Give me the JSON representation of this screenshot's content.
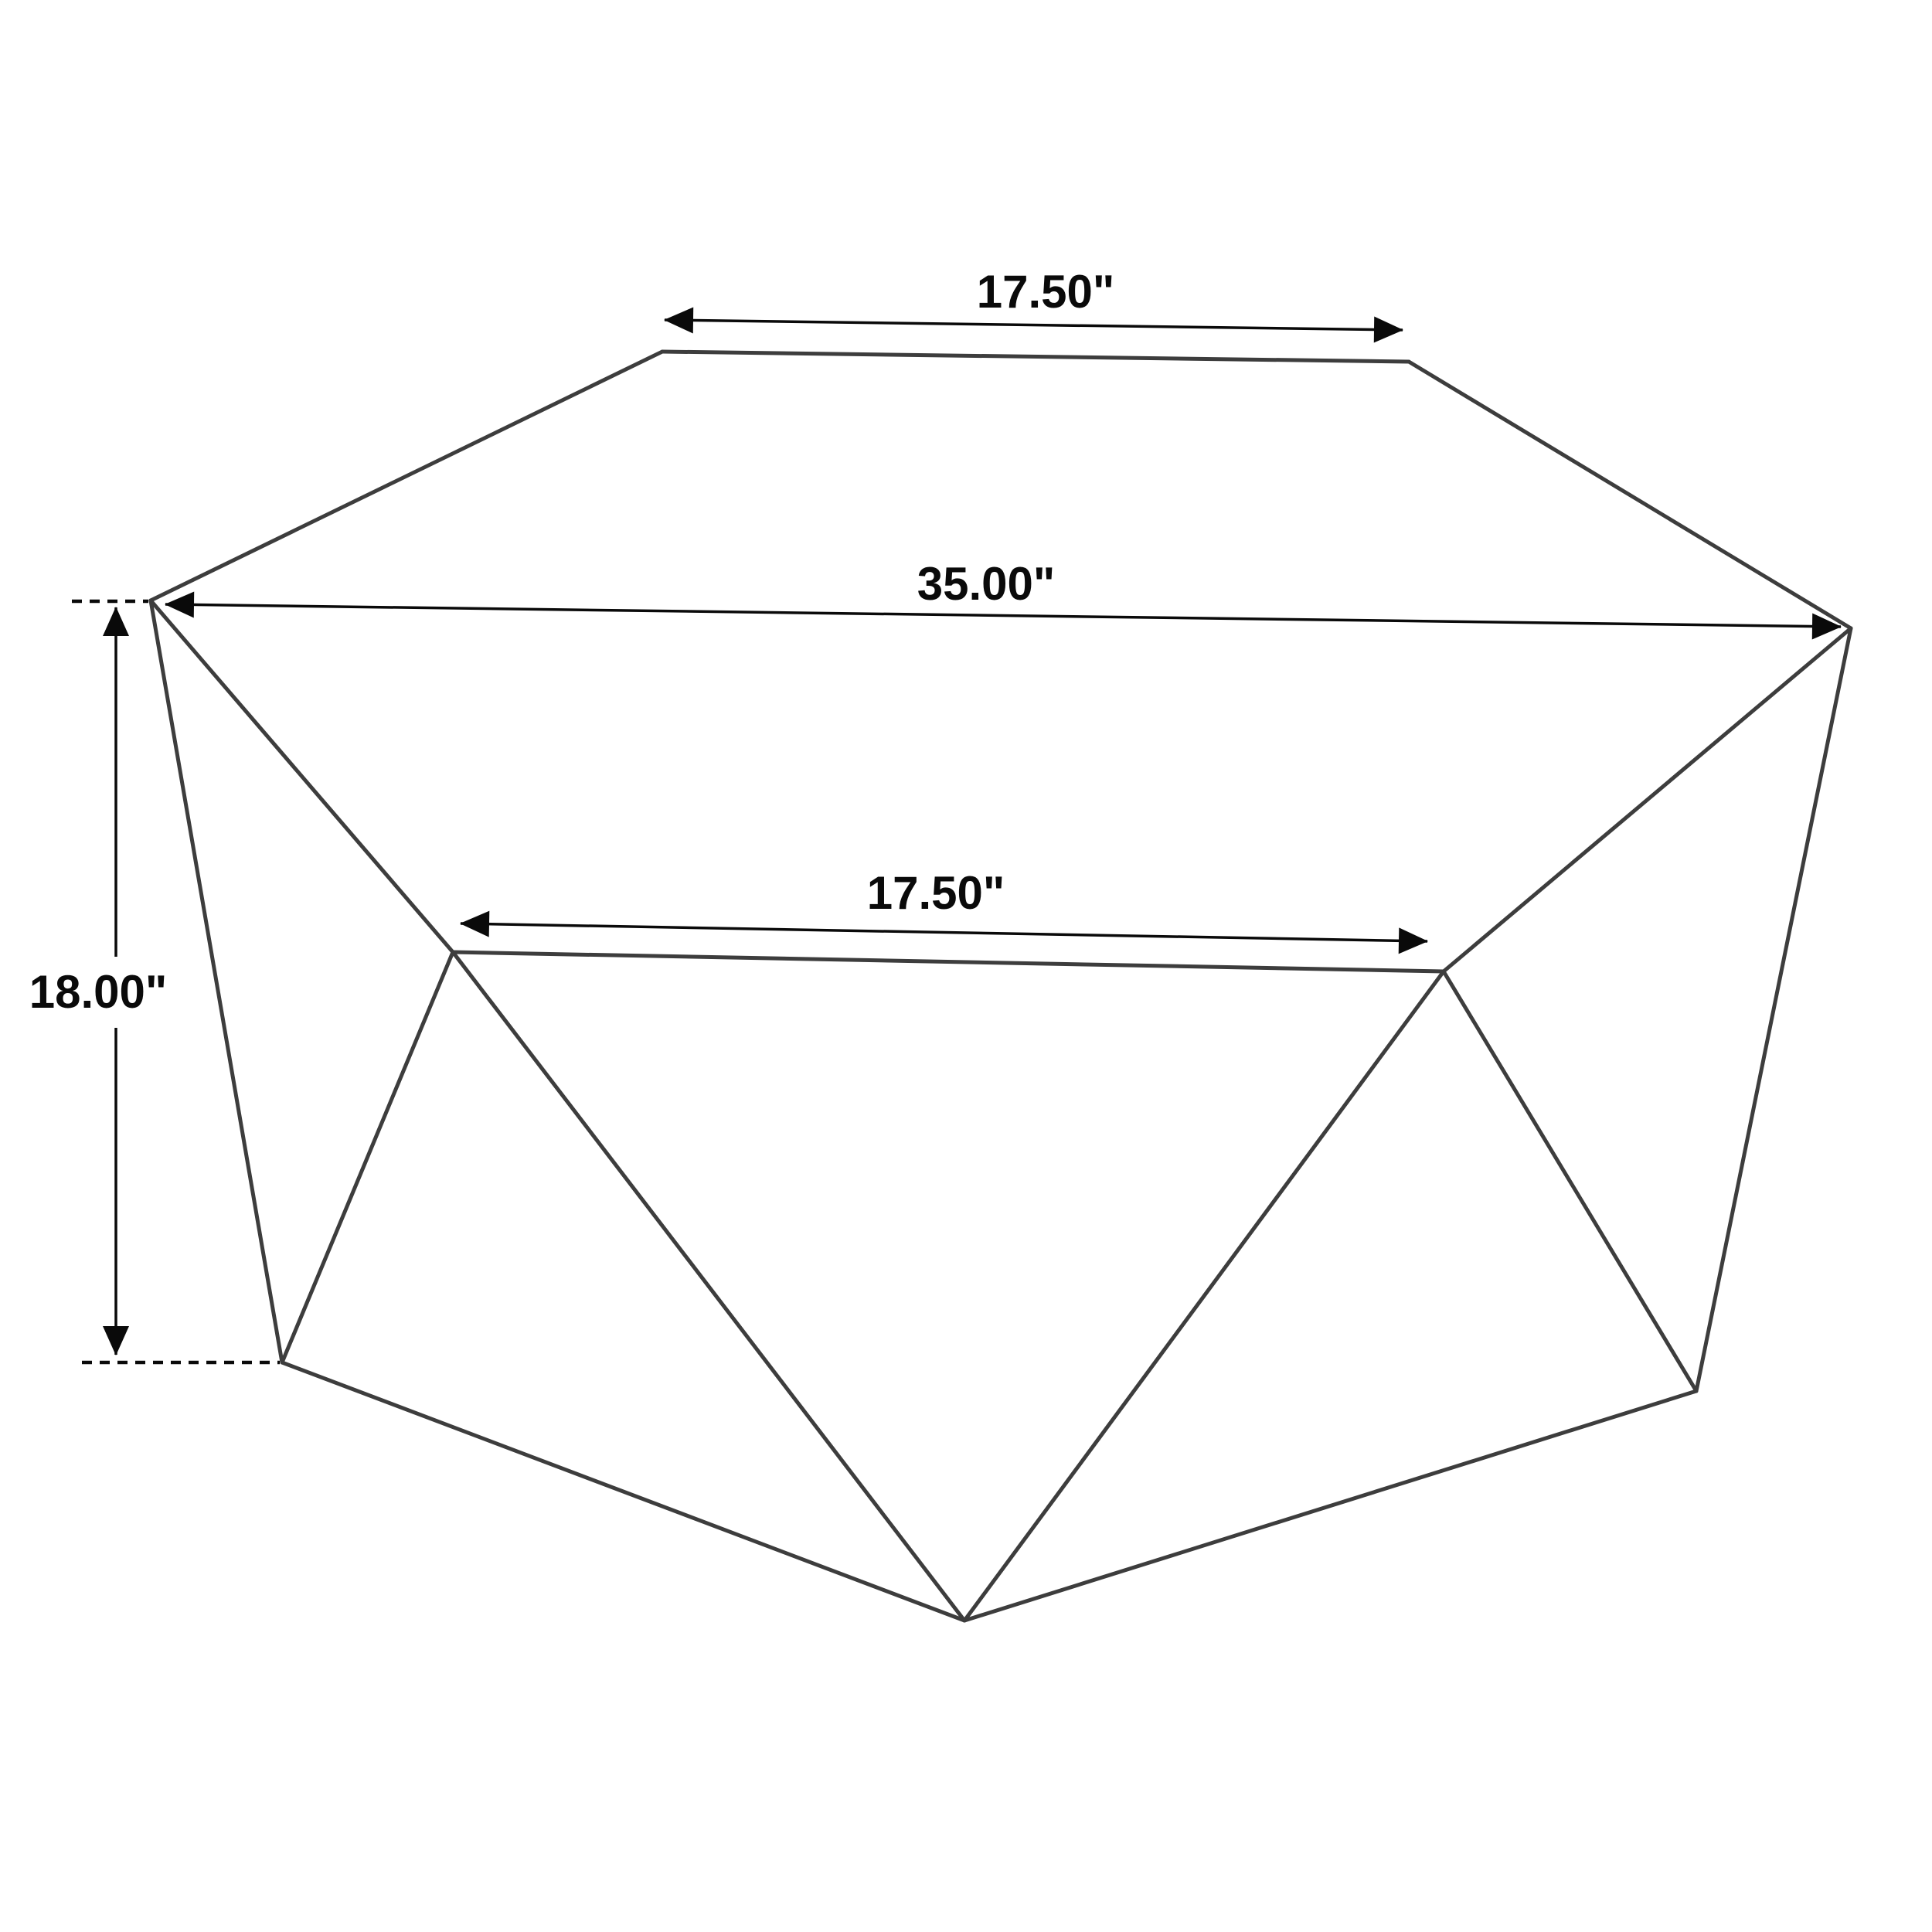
{
  "diagram": {
    "background": "#ffffff",
    "wireframe_color": "#3d3d3d",
    "dimension_color": "#0a0a0a",
    "labels": {
      "top_edge": "17.50\"",
      "overall_width": "35.00\"",
      "front_edge": "17.50\"",
      "height": "18.00\""
    }
  }
}
